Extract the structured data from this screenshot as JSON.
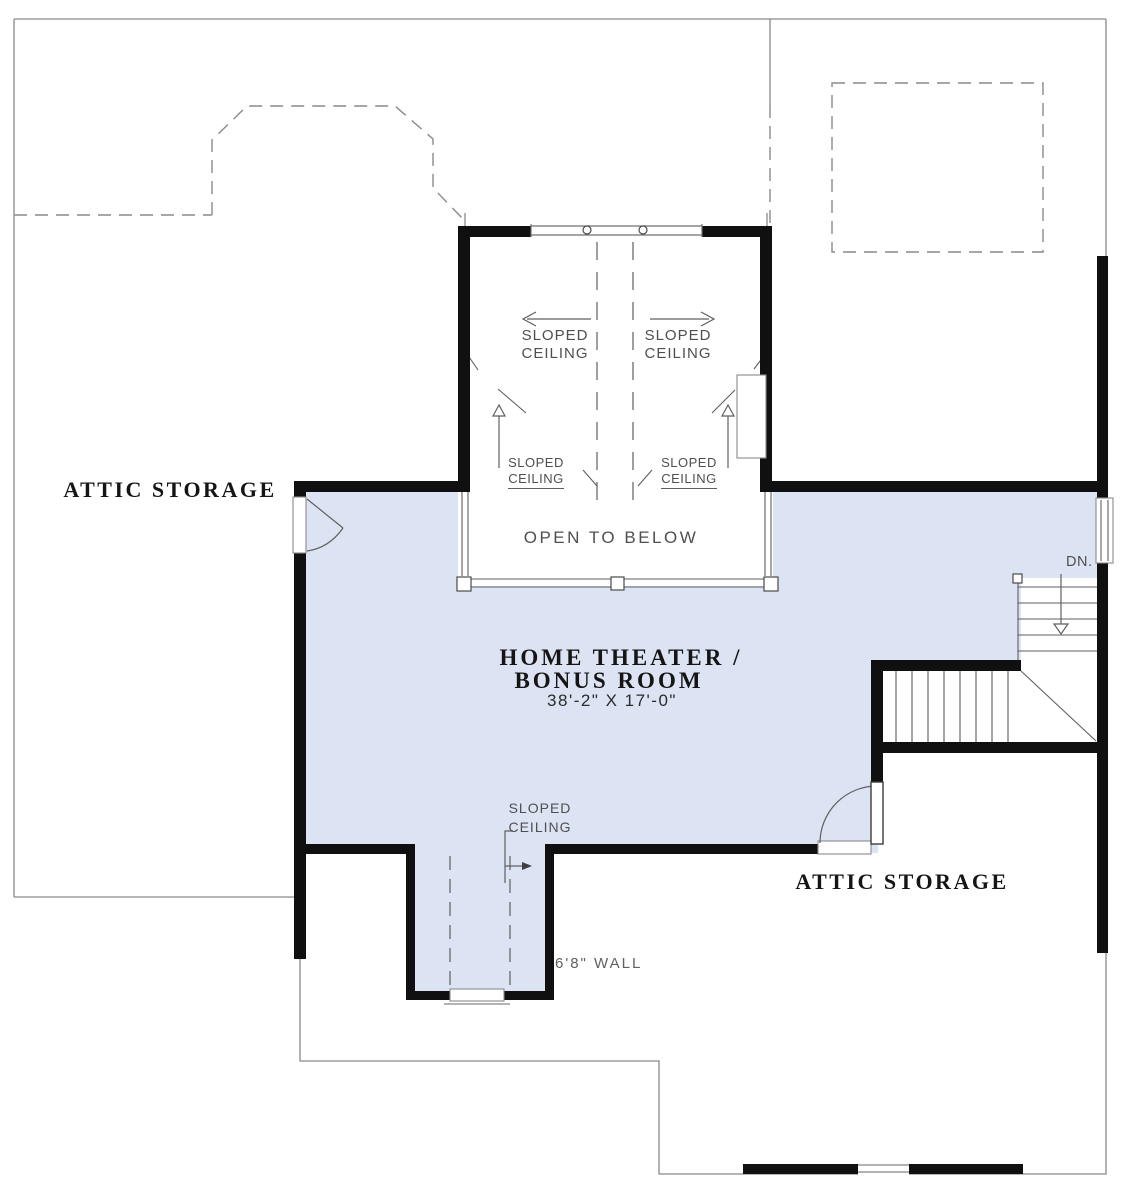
{
  "plan": {
    "floor_description": "second floor plan drawing",
    "rooms": {
      "attic_storage_left": "ATTIC STORAGE",
      "attic_storage_right": "ATTIC STORAGE",
      "bonus_room": {
        "name_line1": "HOME THEATER /",
        "name_line2": "BONUS ROOM",
        "dimensions": "38'-2\" X 17'-0\""
      },
      "open_to_below": "OPEN TO BELOW"
    },
    "annotations": {
      "sloped_upper_left": {
        "line1": "SLOPED",
        "line2": "CEILING"
      },
      "sloped_upper_right": {
        "line1": "SLOPED",
        "line2": "CEILING"
      },
      "sloped_lower_left": {
        "line1": "SLOPED",
        "line2": "CEILING"
      },
      "sloped_lower_right": {
        "line1": "SLOPED",
        "line2": "CEILING"
      },
      "sloped_dormer": {
        "line1": "SLOPED",
        "line2": "CEILING"
      },
      "wall_height_label": "6'8\" WALL",
      "stairs_down_label": "DN."
    }
  },
  "colors": {
    "room_fill": "#dce4f4",
    "wall": "#101010",
    "thin_line": "#8a8a8a",
    "cad_line": "#5f5f5f",
    "cad_text": "#4f4f4f",
    "label_text": "#151515"
  }
}
